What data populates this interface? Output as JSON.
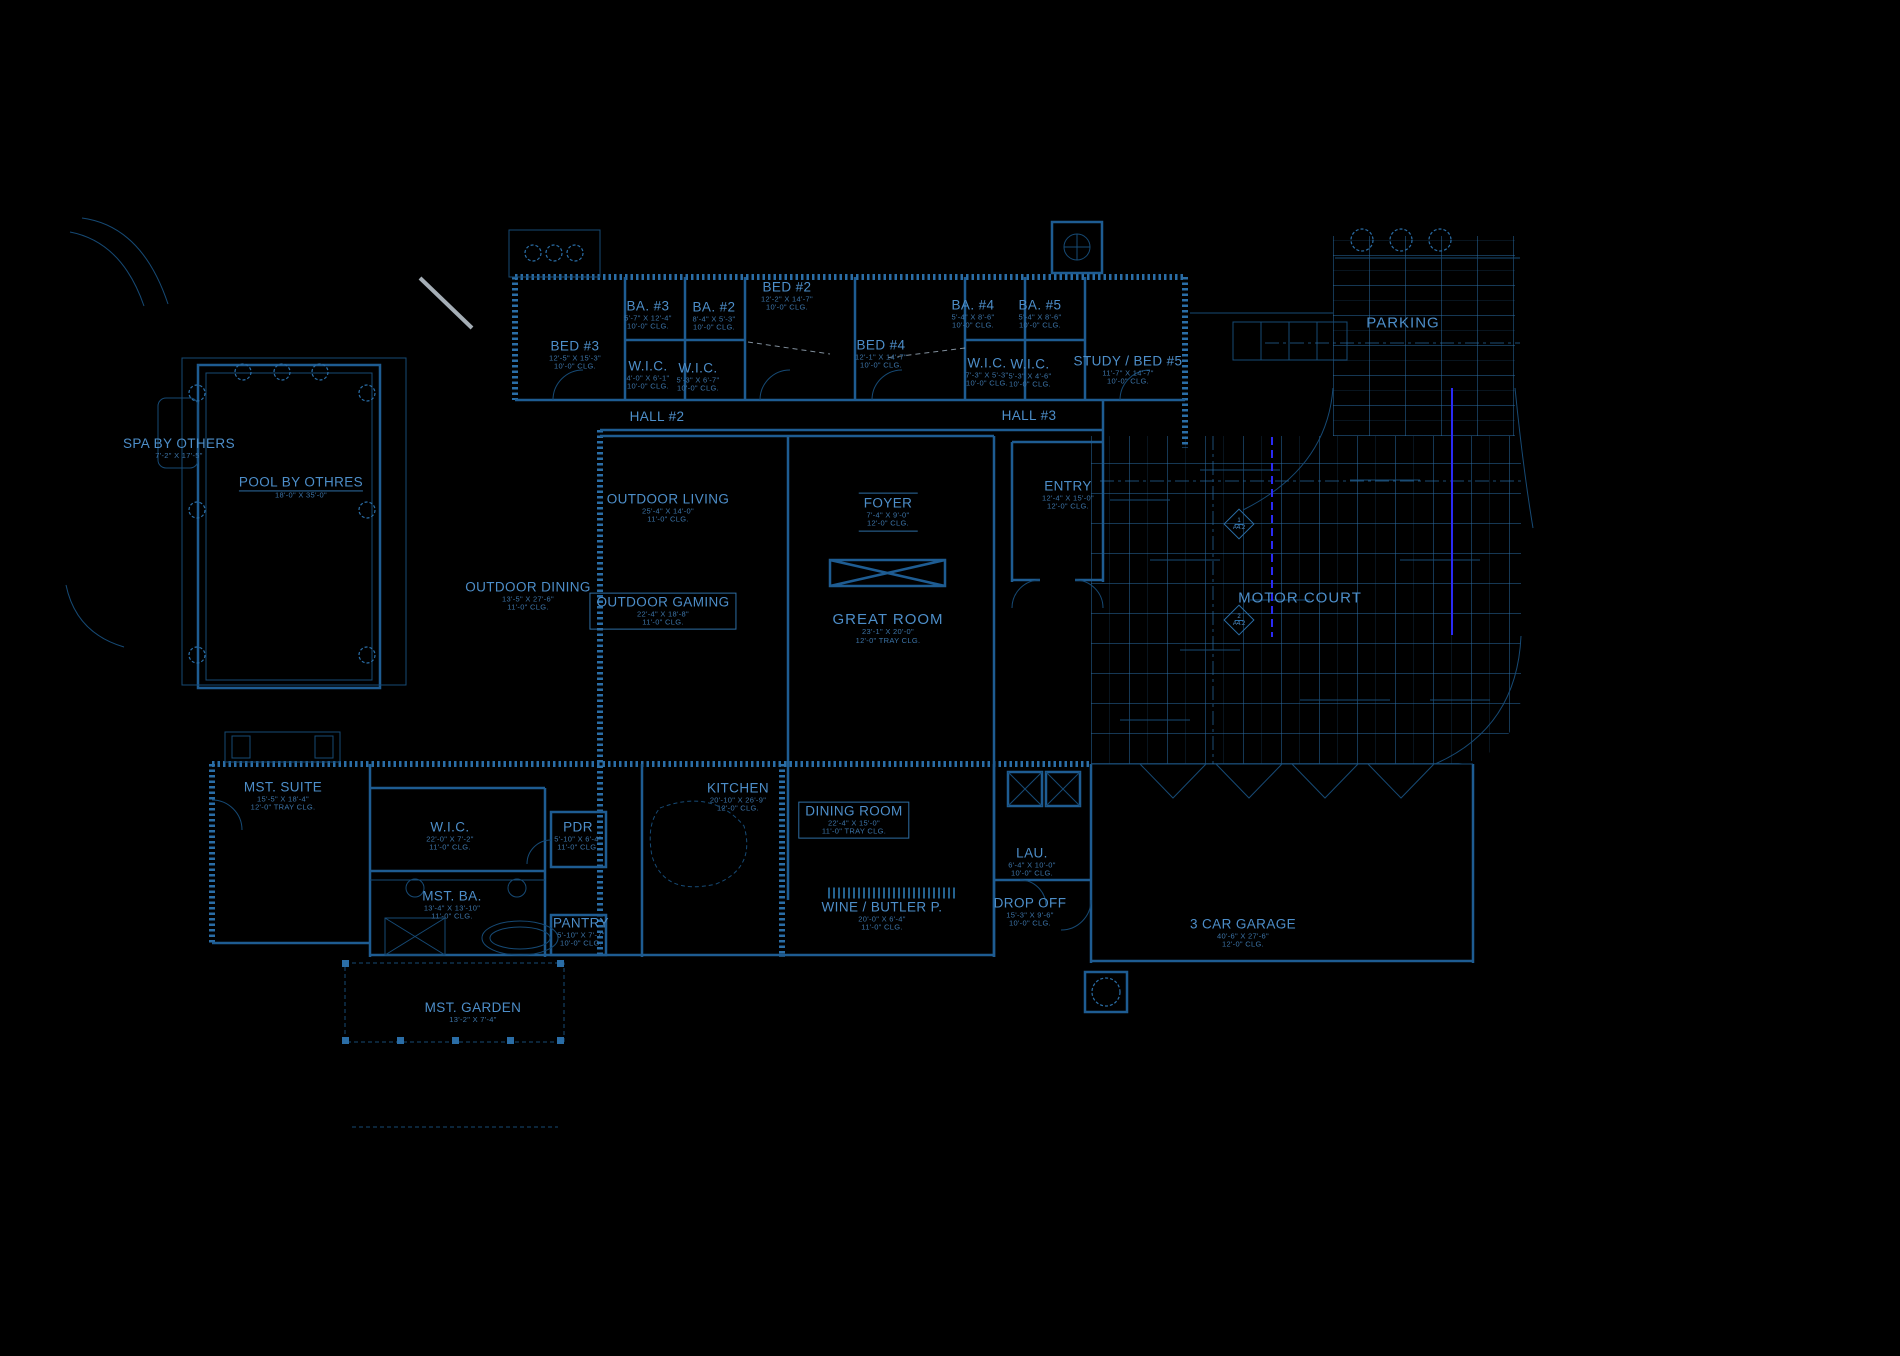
{
  "colors": {
    "background": "#000000",
    "wall_line": "#1e5c92",
    "hatch_line": "#2a6da6",
    "dim_line": "#164a75",
    "label_text": "#4d8ec9",
    "dim_text": "#3c74a8",
    "accent_blue": "#2a2af5",
    "white_line": "#c2ccd6"
  },
  "markers": [
    {
      "num": "1",
      "sheet": "A4.2"
    },
    {
      "num": "2",
      "sheet": "A4.2"
    }
  ],
  "rooms": [
    {
      "name": "SPA BY OTHERS",
      "dims": "7'-2\" X 17'-5\"",
      "clg": ""
    },
    {
      "name": "POOL BY OTHRES",
      "dims": "18'-0\" X 35'-0\"",
      "clg": ""
    },
    {
      "name": "BED #3",
      "dims": "12'-5\" X 15'-3\"",
      "clg": "10'-0\" CLG."
    },
    {
      "name": "BA. #3",
      "dims": "5'-7\" X 12'-4\"",
      "clg": "10'-0\" CLG."
    },
    {
      "name": "BA. #2",
      "dims": "8'-4\" X 5'-3\"",
      "clg": "10'-0\" CLG."
    },
    {
      "name": "W.I.C.",
      "dims": "4'-0\" X 6'-1\"",
      "clg": "10'-0\" CLG."
    },
    {
      "name": "W.I.C.",
      "dims": "5'-3\" X 6'-7\"",
      "clg": "10'-0\" CLG."
    },
    {
      "name": "BED #2",
      "dims": "12'-2\" X 14'-7\"",
      "clg": "10'-0\" CLG."
    },
    {
      "name": "BED #4",
      "dims": "12'-1\" X 14'-7\"",
      "clg": "10'-0\" CLG."
    },
    {
      "name": "BA. #4",
      "dims": "5'-4\" X 8'-6\"",
      "clg": "10'-0\" CLG."
    },
    {
      "name": "BA. #5",
      "dims": "5'-4\" X 8'-6\"",
      "clg": "10'-0\" CLG."
    },
    {
      "name": "W.I.C.",
      "dims": "7'-3\" X 5'-3\"",
      "clg": "10'-0\" CLG."
    },
    {
      "name": "W.I.C.",
      "dims": "5'-3\" X 4'-6\"",
      "clg": "10'-0\" CLG."
    },
    {
      "name": "STUDY / BED #5",
      "dims": "11'-7\" X 14'-7\"",
      "clg": "10'-0\" CLG."
    },
    {
      "name": "HALL #2",
      "dims": "",
      "clg": ""
    },
    {
      "name": "HALL #3",
      "dims": "",
      "clg": ""
    },
    {
      "name": "OUTDOOR LIVING",
      "dims": "25'-4\" X 14'-0\"",
      "clg": "11'-0\" CLG."
    },
    {
      "name": "OUTDOOR DINING",
      "dims": "13'-5\" X 27'-6\"",
      "clg": "11'-0\" CLG."
    },
    {
      "name": "OUTDOOR GAMING",
      "dims": "22'-4\" X 18'-8\"",
      "clg": "11'-0\" CLG."
    },
    {
      "name": "FOYER",
      "dims": "7'-4\" X 9'-0\"",
      "clg": "12'-0\" CLG."
    },
    {
      "name": "GREAT ROOM",
      "dims": "23'-1\" X 20'-0\"",
      "clg": "12'-0\" TRAY CLG."
    },
    {
      "name": "ENTRY",
      "dims": "12'-4\" X 15'-0\"",
      "clg": "12'-0\" CLG."
    },
    {
      "name": "MOTOR COURT",
      "dims": "",
      "clg": ""
    },
    {
      "name": "PARKING",
      "dims": "",
      "clg": ""
    },
    {
      "name": "MST. SUITE",
      "dims": "15'-5\" X 18'-4\"",
      "clg": "12'-0\" TRAY CLG."
    },
    {
      "name": "W.I.C.",
      "dims": "22'-0\" X 7'-2\"",
      "clg": "11'-0\" CLG."
    },
    {
      "name": "MST. BA.",
      "dims": "13'-4\" X 13'-10\"",
      "clg": "11'-0\" CLG."
    },
    {
      "name": "PDR",
      "dims": "5'-10\" X 6'-4\"",
      "clg": "11'-0\" CLG."
    },
    {
      "name": "PANTRY",
      "dims": "5'-10\" X 7'-7\"",
      "clg": "10'-0\" CLG."
    },
    {
      "name": "KITCHEN",
      "dims": "20'-10\" X 26'-9\"",
      "clg": "12'-0\" CLG."
    },
    {
      "name": "DINING ROOM",
      "dims": "22'-4\" X 15'-0\"",
      "clg": "11'-0\" TRAY CLG."
    },
    {
      "name": "WINE / BUTLER P.",
      "dims": "20'-0\" X 6'-4\"",
      "clg": "11'-0\" CLG."
    },
    {
      "name": "LAU.",
      "dims": "6'-4\" X 10'-0\"",
      "clg": "10'-0\" CLG."
    },
    {
      "name": "DROP OFF",
      "dims": "15'-3\" X 9'-6\"",
      "clg": "10'-0\" CLG."
    },
    {
      "name": "3 CAR GARAGE",
      "dims": "40'-6\" X 27'-6\"",
      "clg": "12'-0\" CLG."
    },
    {
      "name": "MST. GARDEN",
      "dims": "13'-2\" X 7'-4\"",
      "clg": ""
    }
  ]
}
